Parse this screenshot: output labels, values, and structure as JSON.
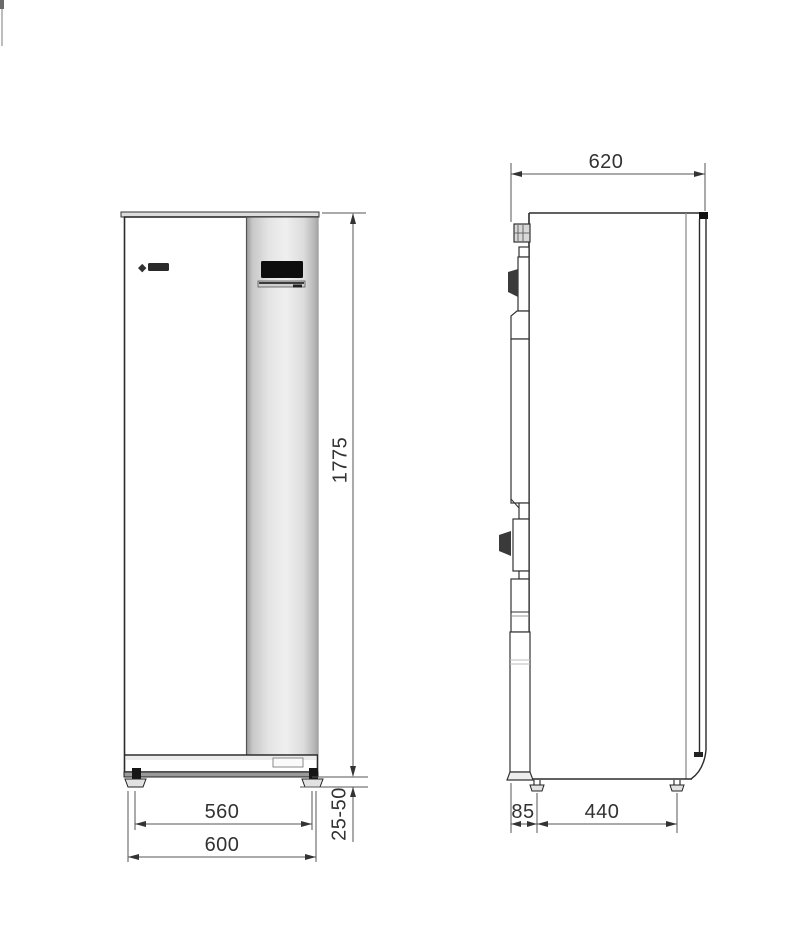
{
  "page": {
    "background": "#ffffff"
  },
  "drawing": {
    "type": "technical-dimension-drawing",
    "front_view": {
      "logo_glyph": "◆",
      "dims": {
        "height": "1775",
        "feet_width": "560",
        "overall_width": "600",
        "foot_adjust_height": "25-50"
      }
    },
    "side_view": {
      "dims": {
        "depth": "620",
        "rear_offset": "85",
        "feet_spacing": "440"
      }
    },
    "colors": {
      "object_line": "#2b2b2b",
      "dimension_line": "#555555",
      "panel_gray": "#d6d6d6",
      "display_black": "#0d0d0d",
      "wedge_dark": "#3a3a3a"
    }
  }
}
